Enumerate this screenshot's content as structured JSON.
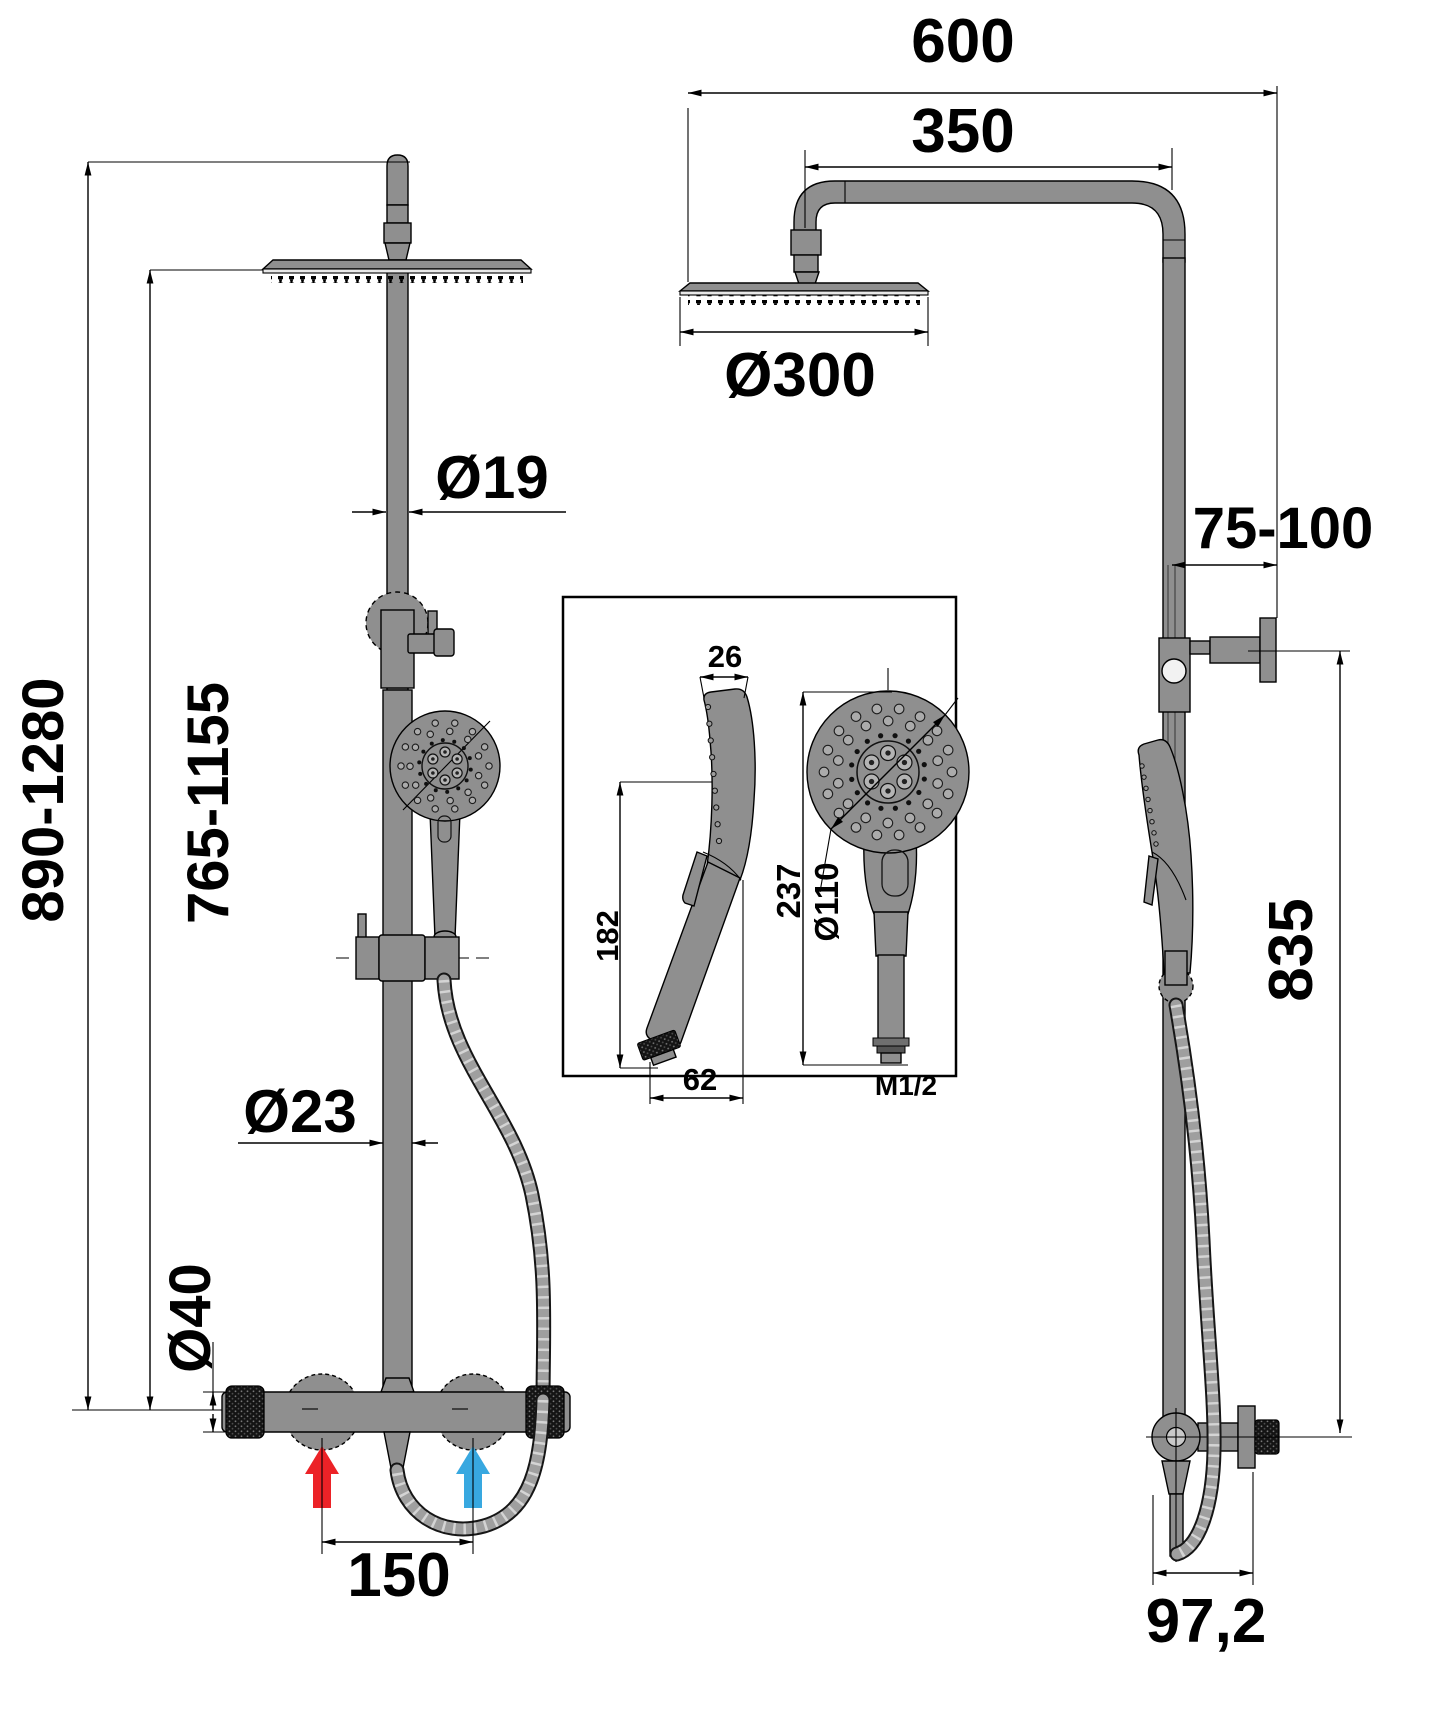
{
  "drawing_type": "shower-system-technical-drawing",
  "dimensions": {
    "front": {
      "overall_height_range": "890-1280",
      "rain_head_height_range": "765-1155",
      "upper_rail_diameter": "Ø19",
      "lower_rail_diameter": "Ø23",
      "valve_body_diameter": "Ø40",
      "inlet_center_distance": "150"
    },
    "overhead": {
      "total_reach": "600",
      "arm_length": "350",
      "rain_head_diameter": "Ø300"
    },
    "side": {
      "wall_clearance_range": "75-100",
      "bracket_to_outlet_height": "835",
      "hose_drop_offset": "97,2"
    },
    "handset": {
      "head_thickness": "26",
      "grip_length": "182",
      "head_reach": "62",
      "total_length": "237",
      "face_diameter": "Ø110",
      "thread_size": "M1/2"
    }
  },
  "colors": {
    "hot": "#ec2227",
    "cold": "#38a8e0",
    "metal": "#8f8f8f",
    "line": "#000000"
  }
}
